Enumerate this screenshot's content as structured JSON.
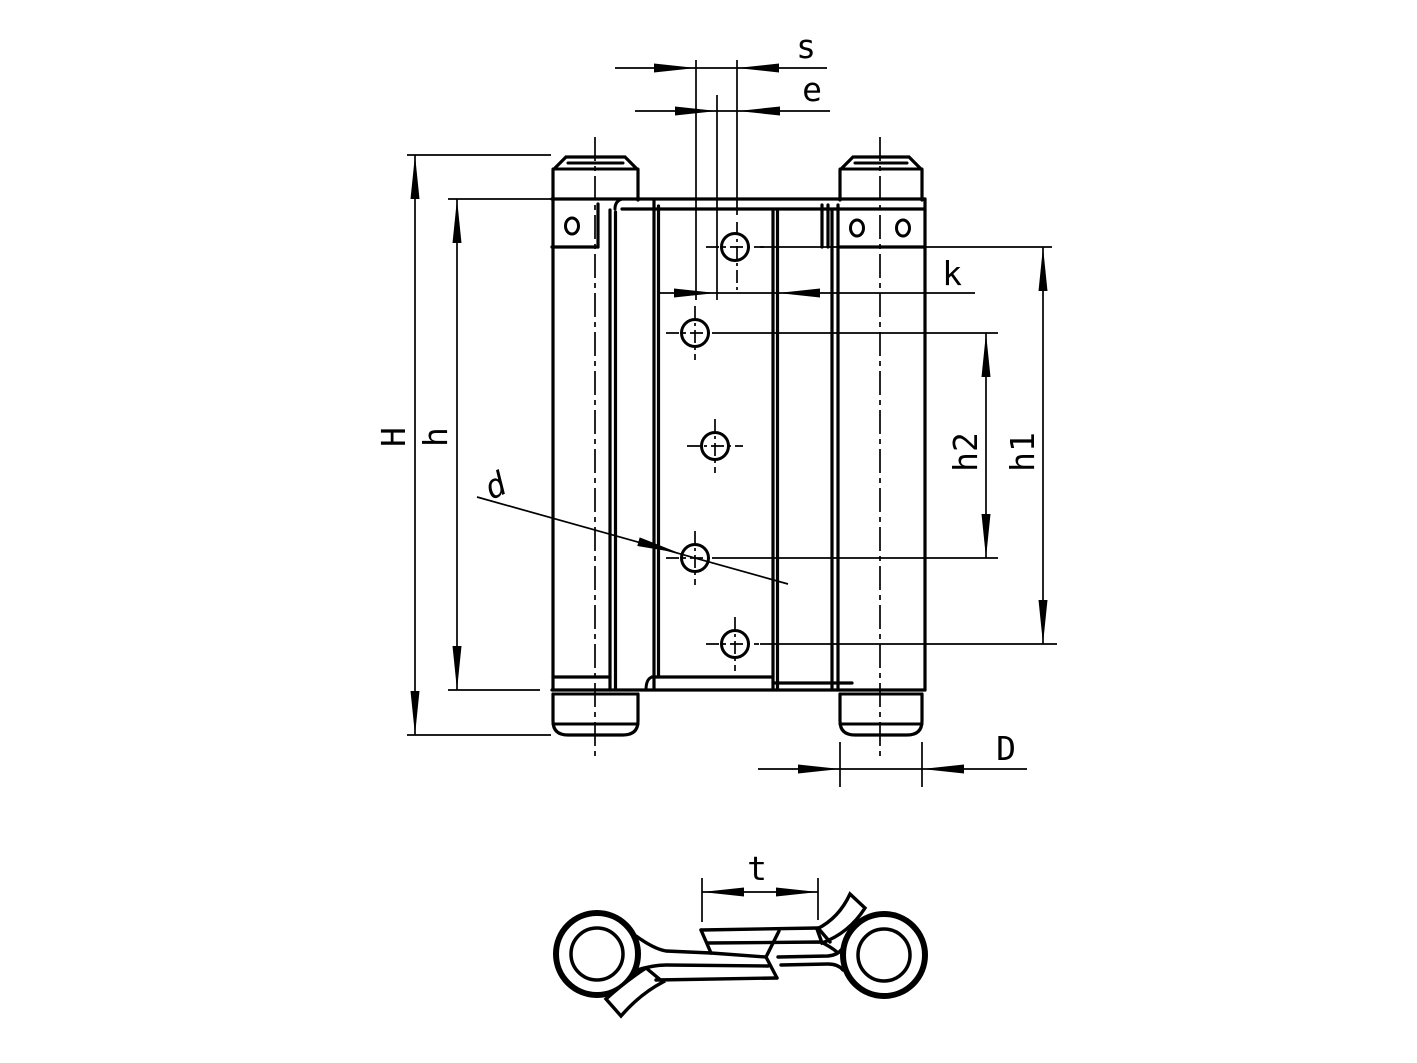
{
  "drawing": {
    "type": "technical-drawing",
    "subject": "double-action spring hinge, front view and cross-section view",
    "line_color": "#000000",
    "background_color": "#ffffff",
    "dimension_labels": {
      "s": "s",
      "e": "e",
      "k": "k",
      "H": "H",
      "h": "h",
      "h1": "h1",
      "h2": "h2",
      "d": "d",
      "D": "D",
      "t": "t"
    }
  }
}
